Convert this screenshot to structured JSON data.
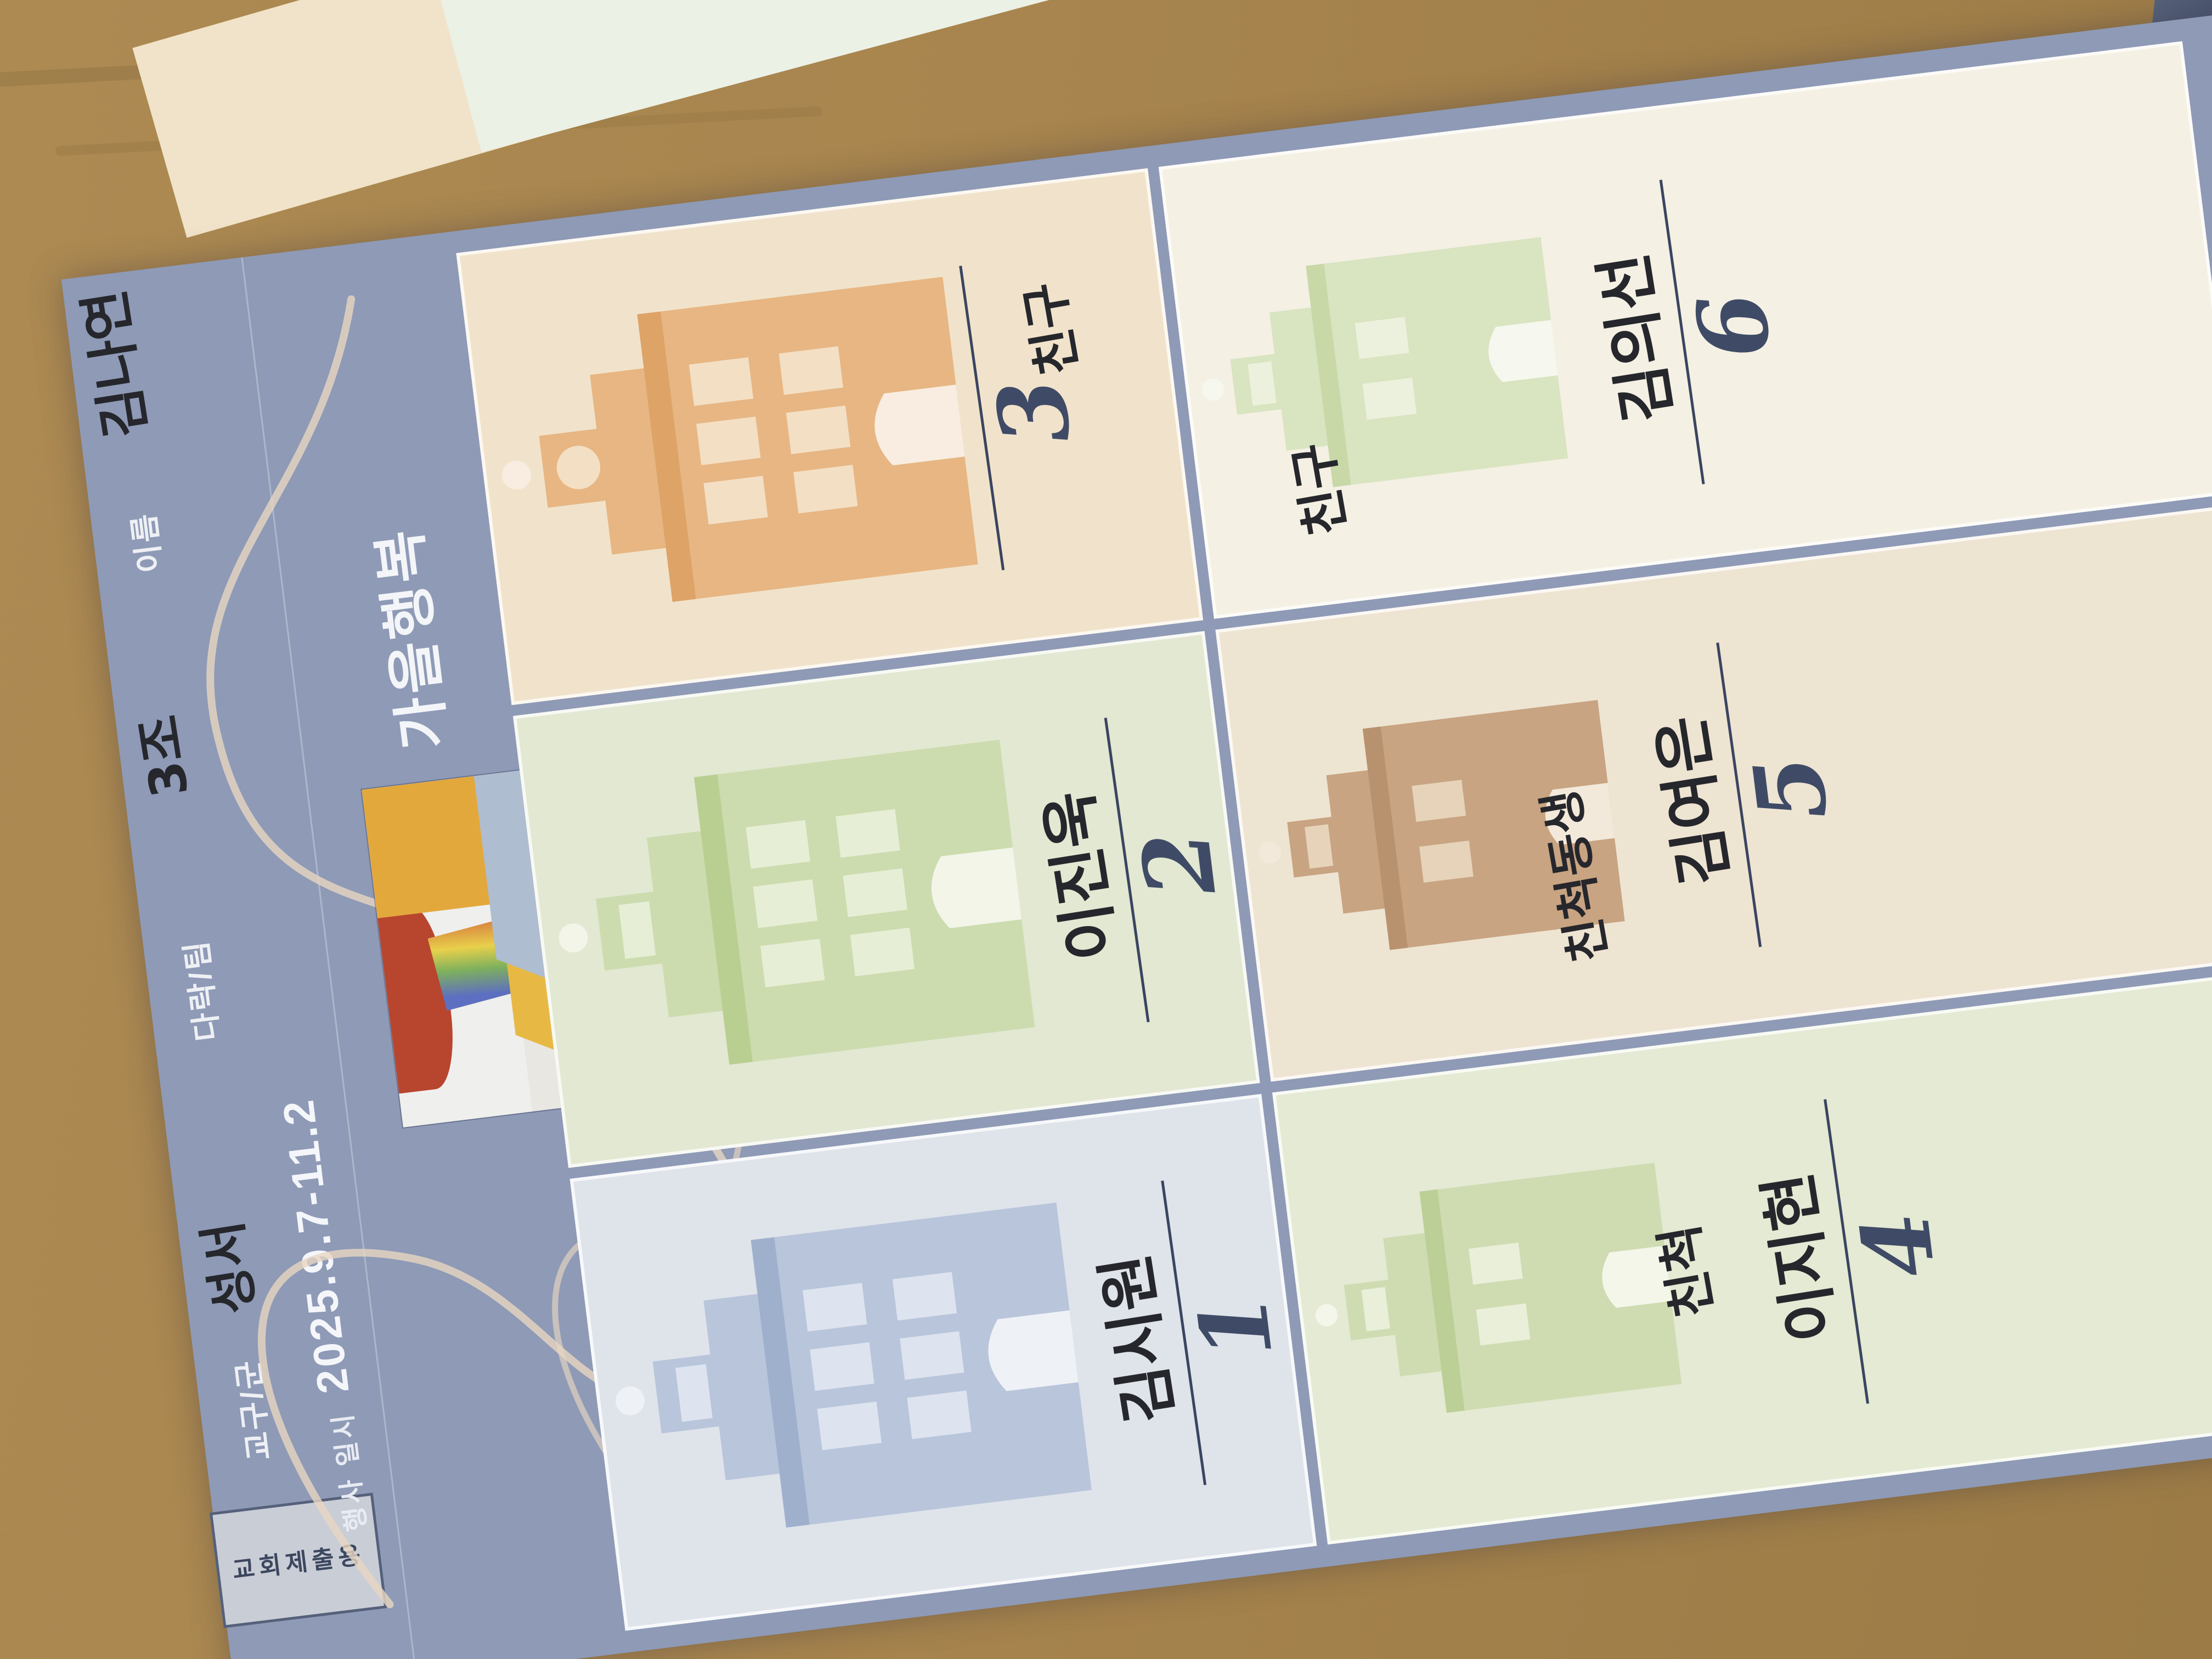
{
  "scene": {
    "description": "photo of a paper church-event form lying rotated about 97 degrees counter-clockwise on a wooden table",
    "wood_color": "#a8854e",
    "paper_color": "#8e9ab6"
  },
  "form": {
    "submit_tab": "교회제출용",
    "header_fields": [
      {
        "label": "교구/군",
        "value": "성서"
      },
      {
        "label": "다락/팀",
        "value": "3조"
      },
      {
        "label": "이름",
        "value": "김나연"
      }
    ],
    "event_label": "행사 일시",
    "event_date": "2025.9.7-11.2",
    "title": "가을행복",
    "subtitle_line1": "다락방에서",
    "subtitle_line2": "함께하는",
    "calligraphy_note": "large decorative cream cursive pen flourishes (illegible script)",
    "illustration_note": "small colorful painting of an open laptop with red, rainbow and yellow artwork",
    "cards": [
      {
        "number": "1",
        "name": "김시원",
        "relation": ""
      },
      {
        "number": "2",
        "name": "이진욱",
        "relation": ""
      },
      {
        "number": "3",
        "name": "",
        "relation": "친구"
      },
      {
        "number": "4",
        "name": "이지현",
        "relation": "친척"
      },
      {
        "number": "5",
        "name": "김여은",
        "relation": "친척동생"
      },
      {
        "number": "6",
        "name": "김의선",
        "relation": "친구"
      }
    ]
  }
}
